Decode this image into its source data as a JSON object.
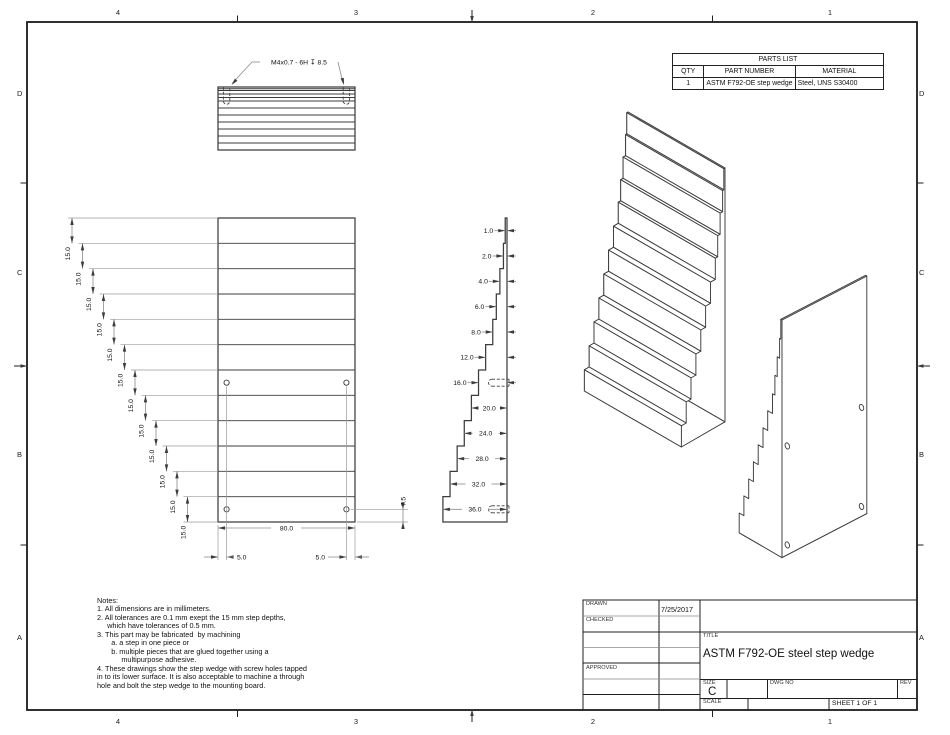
{
  "sheet": {
    "zones": {
      "top": [
        "4",
        "3",
        "2",
        "1"
      ],
      "bottom": [
        "4",
        "3",
        "2",
        "1"
      ],
      "left": [
        "D",
        "C",
        "B",
        "A"
      ],
      "right": [
        "D",
        "C",
        "B",
        "A"
      ]
    }
  },
  "parts_list": {
    "title": "PARTS LIST",
    "headers": [
      "QTY",
      "PART NUMBER",
      "MATERIAL"
    ],
    "rows": [
      [
        "1",
        "ASTM F792-OE step wedge",
        "Steel, UNS S30400"
      ]
    ]
  },
  "drawing": {
    "thread_callout": "M4x0.7 - 6H ↧ 8.5",
    "step_height_mm": 15,
    "step_height_label": "15.0",
    "step_depths_mm": [
      1,
      2,
      4,
      6,
      8,
      12,
      16,
      20,
      24,
      28,
      32,
      36
    ],
    "depth_labels": [
      "1.0",
      "2.0",
      "4.0",
      "6.0",
      "8.0",
      "12.0",
      "16.0",
      "20.0",
      "24.0",
      "28.0",
      "32.0",
      "36.0"
    ],
    "width_label": "80.0",
    "hole_edge_offset_label": "5.0",
    "hole_bottom_offset_label": "7.5"
  },
  "notes": {
    "lines": [
      "Notes:",
      "1. All dimensions are in millimeters.",
      "2. All tolerances are 0.1 mm exept the 15 mm step depths,",
      "     which have tolerances of 0.5 mm.",
      "3. This part may be fabricated  by machining",
      "       a. a step in one piece or",
      "       b. multiple pieces that are glued together using a",
      "            multipurpose adhesive.",
      "4. These drawings show the step wedge with screw holes tapped",
      "in to its lower surface. It is also acceptable to machine a through",
      "hole and bolt the step wedge to the mounting board."
    ]
  },
  "title_block": {
    "drawn_label": "DRAWN",
    "drawn_date": "7/25/2017",
    "checked_label": "CHECKED",
    "approved_label": "APPROVED",
    "title_label": "TITLE",
    "title": "ASTM F792-OE steel step wedge",
    "size_label": "SIZE",
    "size": "C",
    "dwg_no_label": "DWG NO",
    "rev_label": "REV",
    "scale_label": "SCALE",
    "sheet_label": "SHEET 1  OF 1"
  }
}
